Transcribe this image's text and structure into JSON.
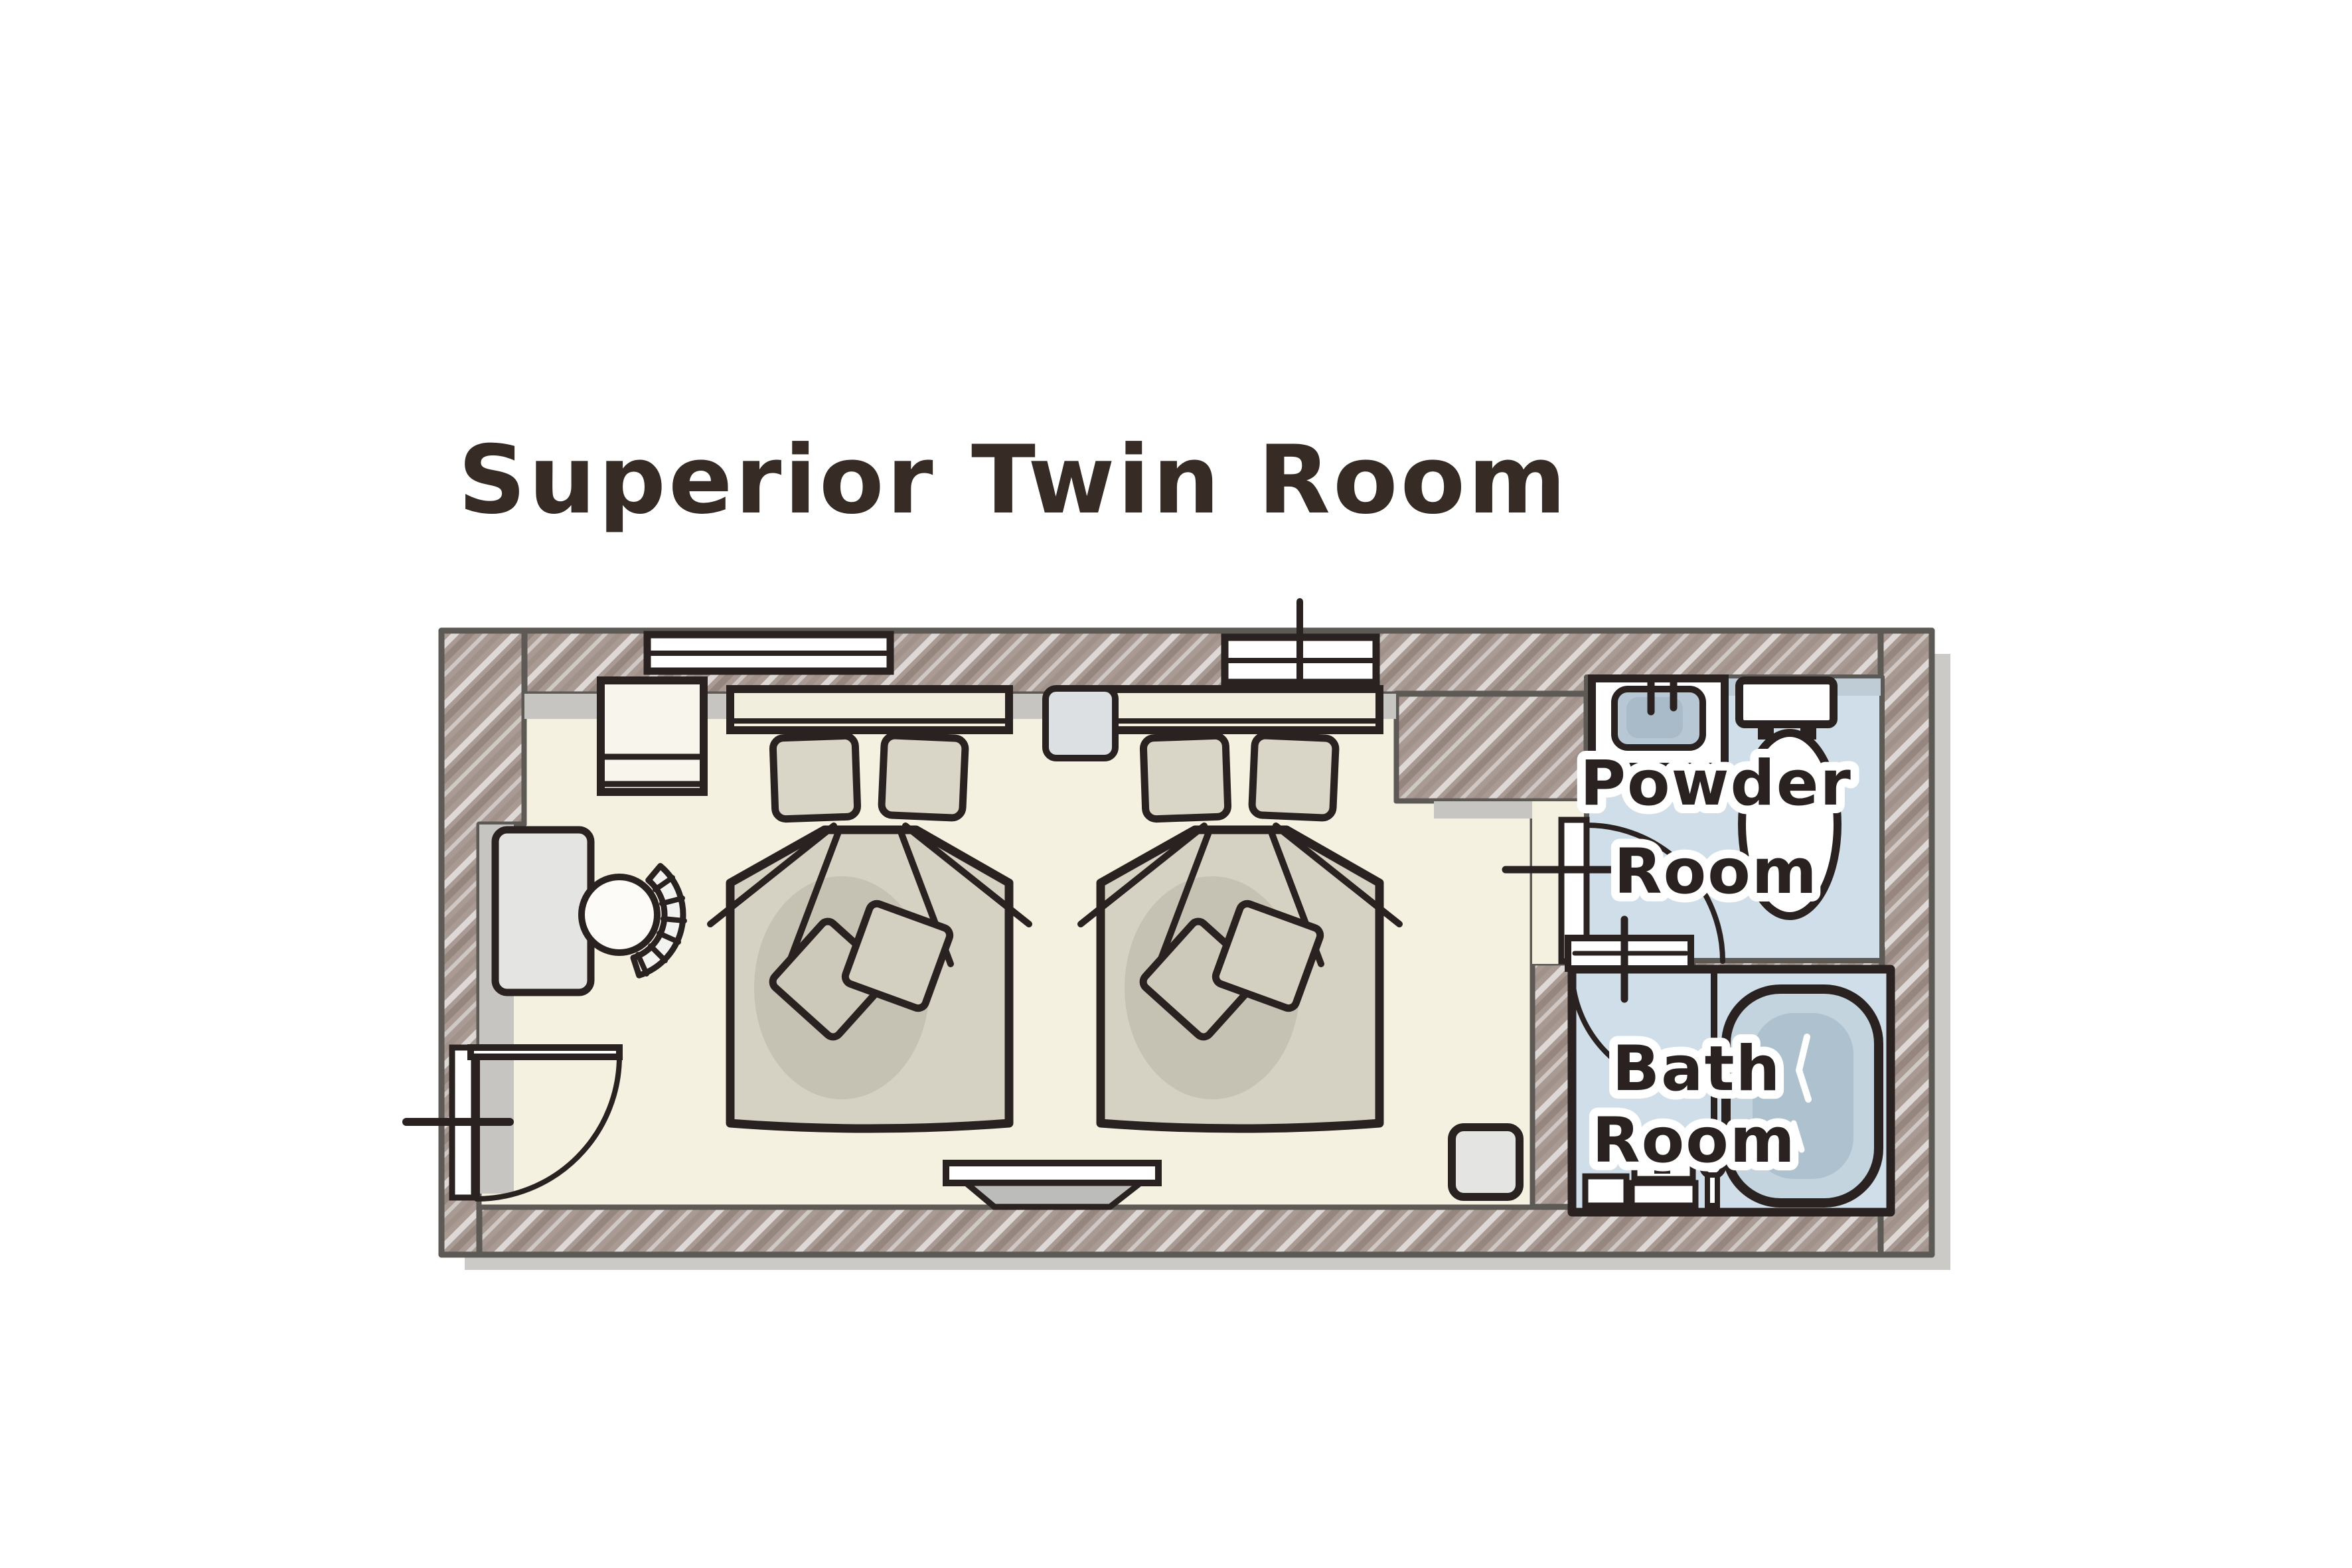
{
  "title": "Superior Twin Room",
  "rooms": {
    "main": {
      "name": "bedroom"
    },
    "powder": {
      "label_line1": "Powder",
      "label_line2": "Room"
    },
    "bath": {
      "label_line1": "Bath",
      "label_line2": "Room"
    }
  },
  "furniture_icons": [
    "closet-icon",
    "desk-icon",
    "chair-icon",
    "double-bed-icon",
    "double-bed-icon",
    "night-stand-icon",
    "tv-board-icon",
    "stool-icon",
    "window-icon",
    "window-icon",
    "swing-door-icon",
    "swing-door-icon",
    "swing-door-icon",
    "wash-basin-icon",
    "toilet-icon",
    "bathtub-icon",
    "shower-set-icon"
  ],
  "colors": {
    "background": "#ffffff",
    "ink": "#2a2220",
    "title_ink": "#362b25",
    "wall_fill": "#a99b94",
    "wall_outline": "#5d5955",
    "floor_cream": "#f5f1e1",
    "wet_room_blue": "#cfdee8",
    "bed_taupe": "#d6d2c3",
    "furniture_gray": "#e4e4e2",
    "plan_shadow": "#cccac7"
  }
}
